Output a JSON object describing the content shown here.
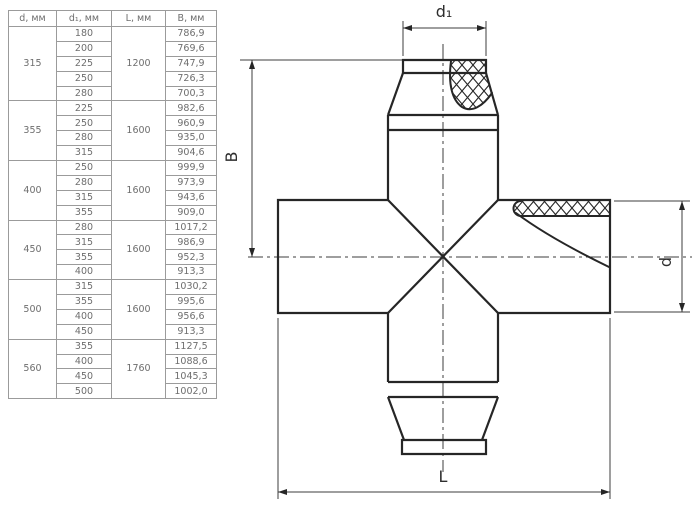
{
  "table": {
    "columns": [
      "d, мм",
      "d₁, мм",
      "L, мм",
      "B, мм"
    ],
    "groups": [
      {
        "d": "315",
        "L": "1200",
        "rows": [
          {
            "d1": "180",
            "B": "786,9"
          },
          {
            "d1": "200",
            "B": "769,6"
          },
          {
            "d1": "225",
            "B": "747,9"
          },
          {
            "d1": "250",
            "B": "726,3"
          },
          {
            "d1": "280",
            "B": "700,3"
          }
        ]
      },
      {
        "d": "355",
        "L": "1600",
        "rows": [
          {
            "d1": "225",
            "B": "982,6"
          },
          {
            "d1": "250",
            "B": "960,9"
          },
          {
            "d1": "280",
            "B": "935,0"
          },
          {
            "d1": "315",
            "B": "904,6"
          }
        ]
      },
      {
        "d": "400",
        "L": "1600",
        "rows": [
          {
            "d1": "250",
            "B": "999,9"
          },
          {
            "d1": "280",
            "B": "973,9"
          },
          {
            "d1": "315",
            "B": "943,6"
          },
          {
            "d1": "355",
            "B": "909,0"
          }
        ]
      },
      {
        "d": "450",
        "L": "1600",
        "rows": [
          {
            "d1": "280",
            "B": "1017,2"
          },
          {
            "d1": "315",
            "B": "986,9"
          },
          {
            "d1": "355",
            "B": "952,3"
          },
          {
            "d1": "400",
            "B": "913,3"
          }
        ]
      },
      {
        "d": "500",
        "L": "1600",
        "rows": [
          {
            "d1": "315",
            "B": "1030,2"
          },
          {
            "d1": "355",
            "B": "995,6"
          },
          {
            "d1": "400",
            "B": "956,6"
          },
          {
            "d1": "450",
            "B": "913,3"
          }
        ]
      },
      {
        "d": "560",
        "L": "1760",
        "rows": [
          {
            "d1": "355",
            "B": "1127,5"
          },
          {
            "d1": "400",
            "B": "1088,6"
          },
          {
            "d1": "450",
            "B": "1045,3"
          },
          {
            "d1": "500",
            "B": "1002,0"
          }
        ]
      }
    ]
  },
  "drawing": {
    "labels": {
      "top": "d₁",
      "left": "B",
      "right": "d",
      "bottom": "L"
    }
  },
  "colors": {
    "line": "#262626",
    "table_border": "#9b9b9b",
    "table_text": "#6e6e6e"
  }
}
